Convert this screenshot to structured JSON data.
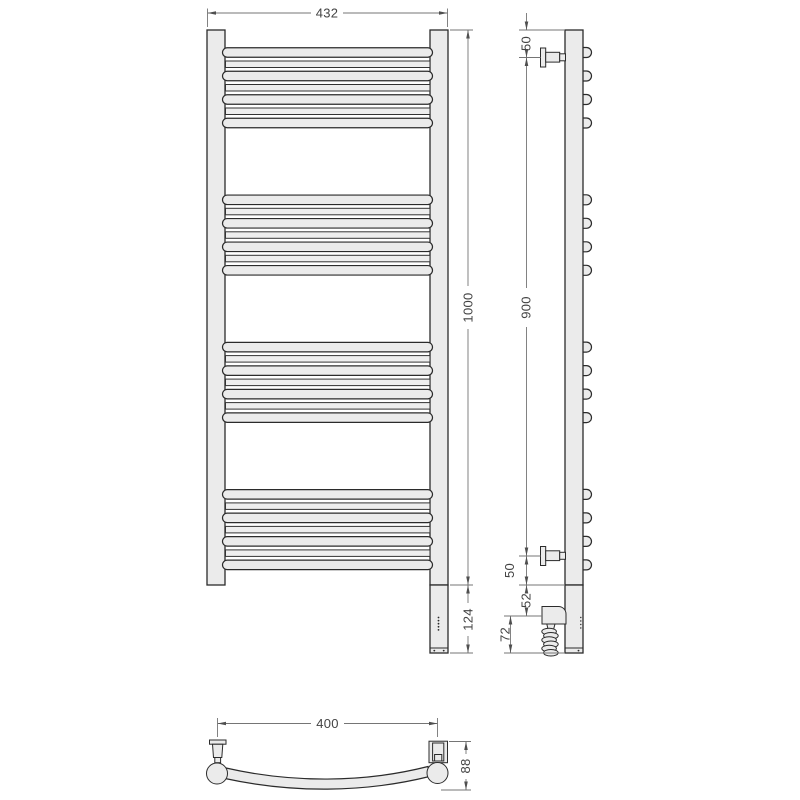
{
  "dims": {
    "overall_width": "432",
    "overall_height": "1000",
    "heater_housing_height": "124",
    "top_to_bracket": "50",
    "bracket_span": "900",
    "bracket_to_housing": "50",
    "housing_to_element": "52",
    "element_to_bottom": "72",
    "bar_centers_width": "400",
    "depth": "88"
  },
  "structure": {
    "bar_groups": 4,
    "thick_bars_per_group": 4,
    "thin_bars_per_group": 3,
    "coil_loops": 6,
    "led_dots": 5
  },
  "colors": {
    "part_fill": "#ebebeb",
    "part_outline": "#2b2b2b",
    "dimension_line": "#757575",
    "dimension_text": "#434343",
    "background": "#ffffff"
  }
}
